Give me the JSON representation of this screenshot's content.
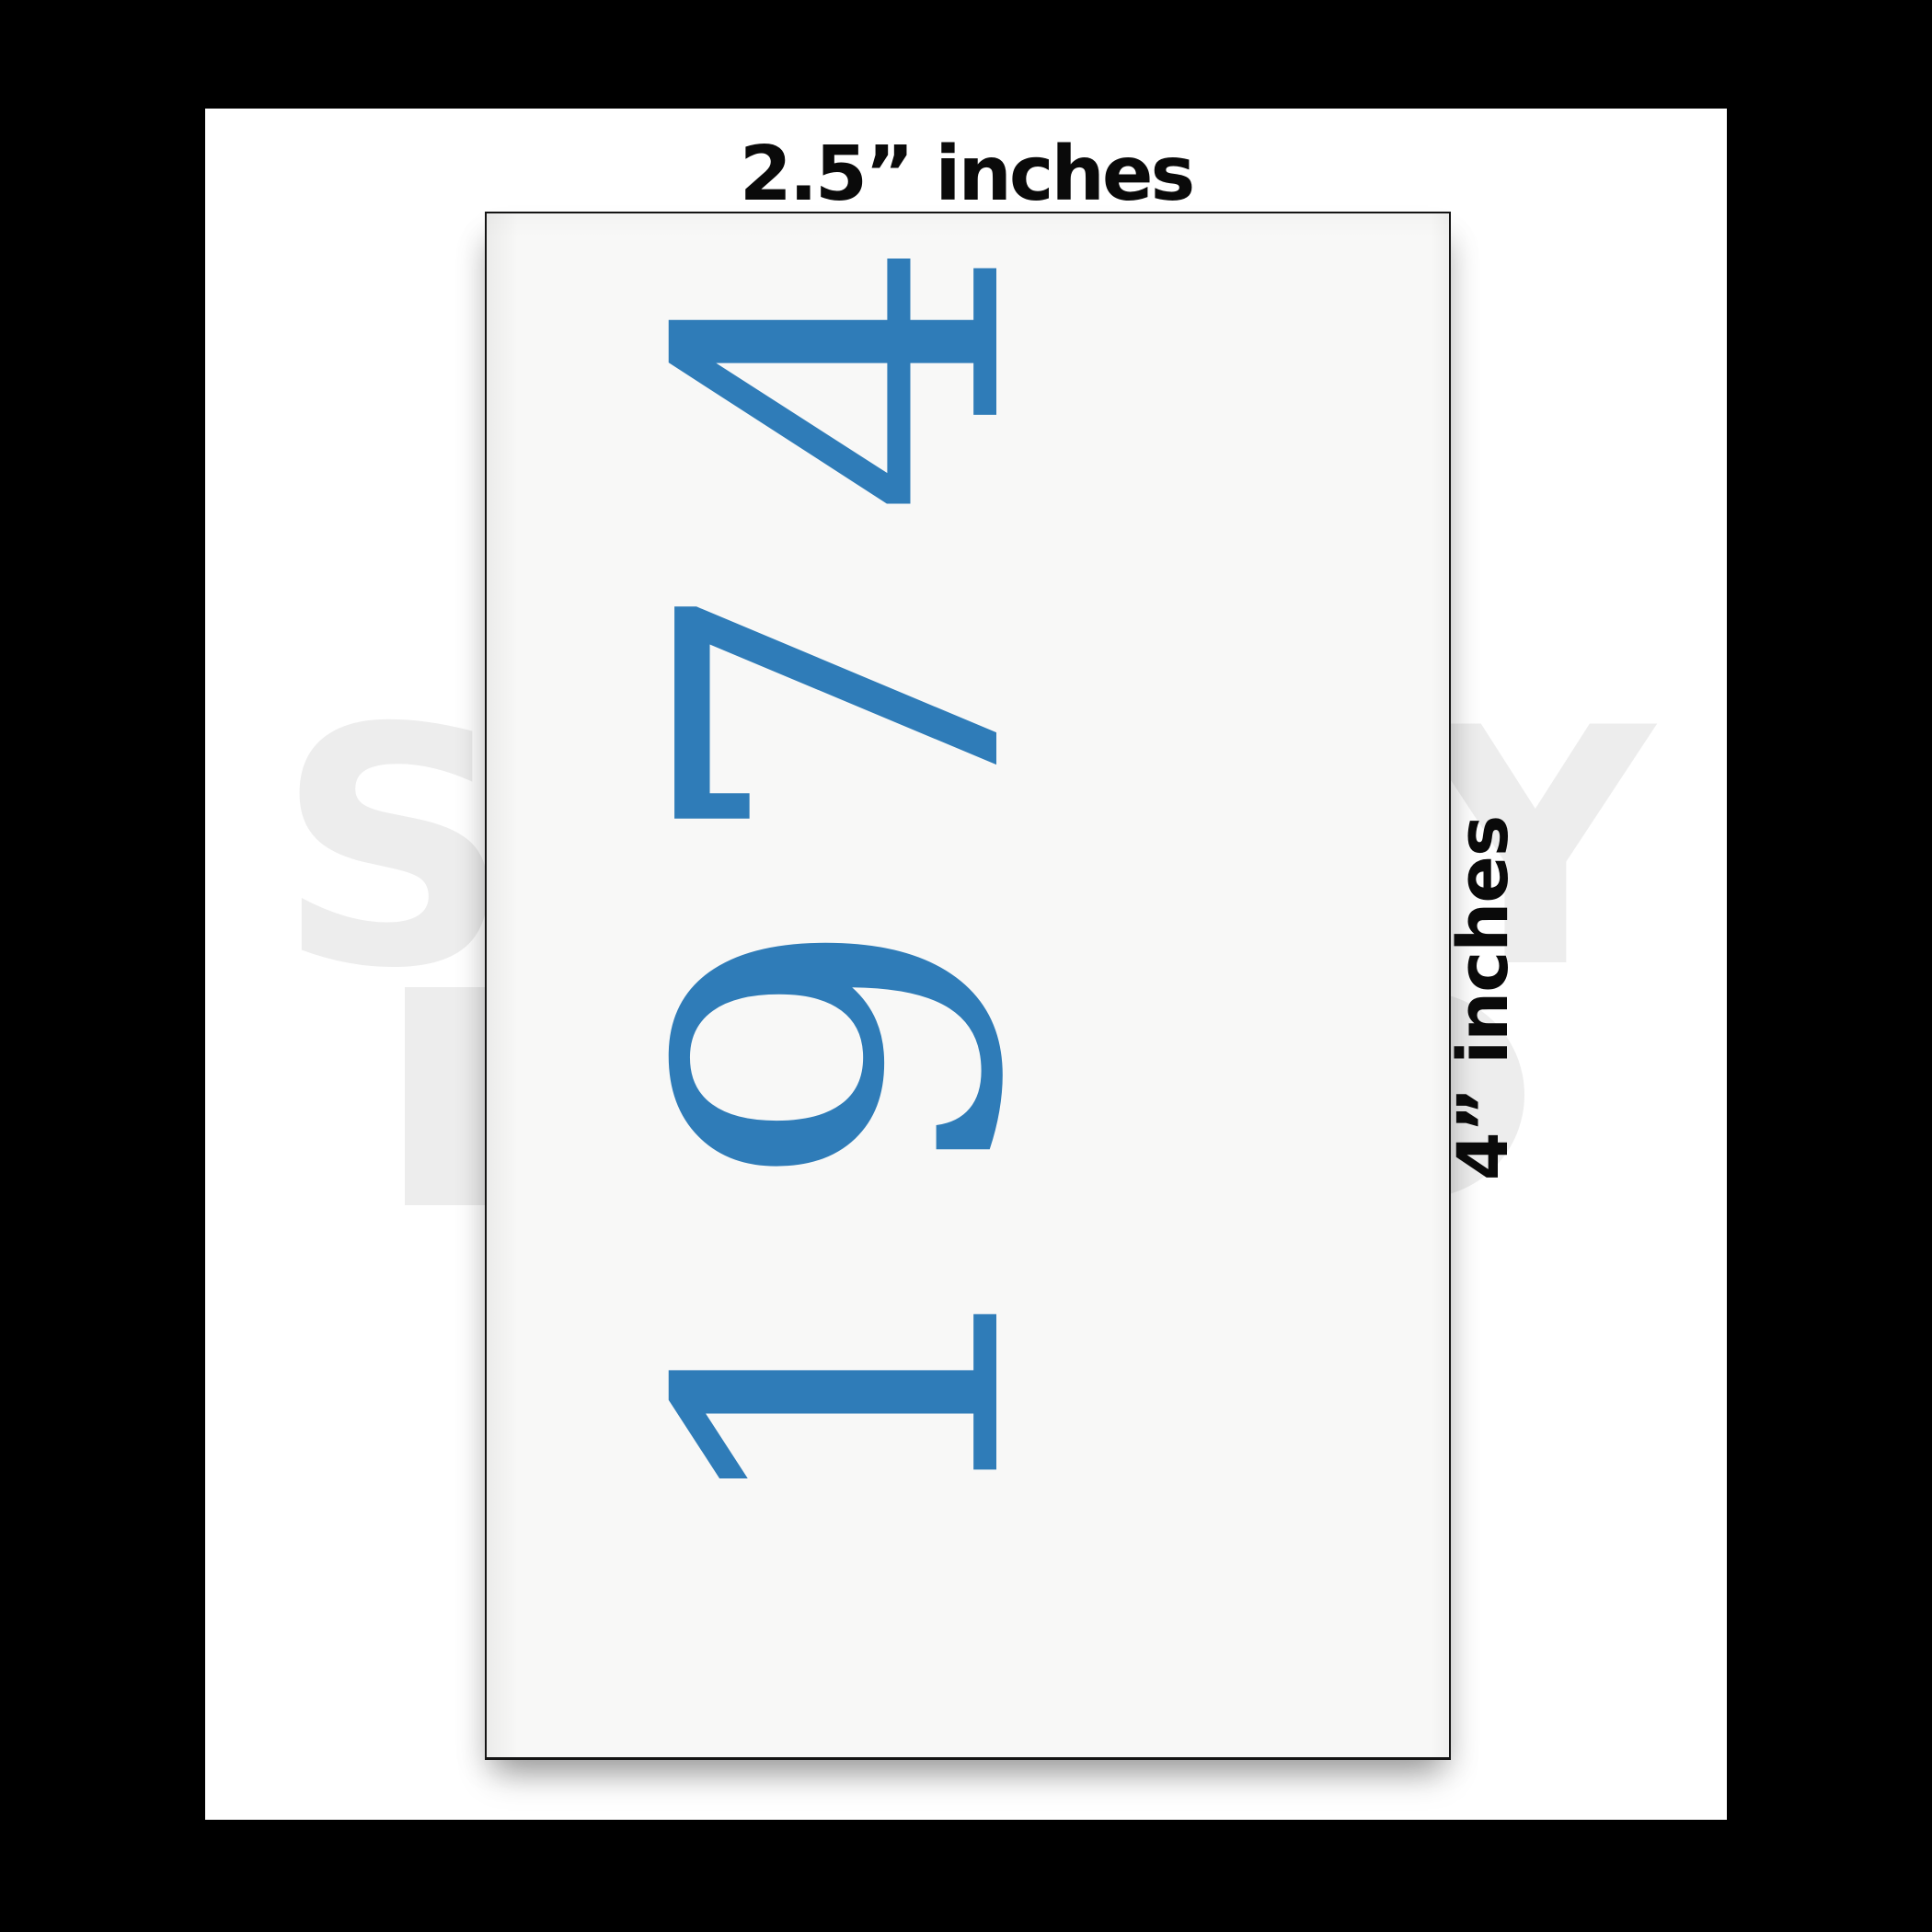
{
  "scene": {
    "top_dimension_label": "2.5” inches",
    "side_dimension_label": "4” inches"
  },
  "card": {
    "year_text": "1974",
    "year_color": "#2f7cb8",
    "width_inches": "2.5",
    "height_inches": "4"
  },
  "watermark": {
    "letter_left": "S",
    "letter_right": "Y"
  },
  "colors": {
    "frame": "#000000",
    "background": "#ffffff",
    "card_fill": "#f8f8f7",
    "card_border": "#141414",
    "label_text": "#0a0a0a",
    "watermark_gray": "#ededed",
    "year_blue": "#2f7cb8"
  }
}
